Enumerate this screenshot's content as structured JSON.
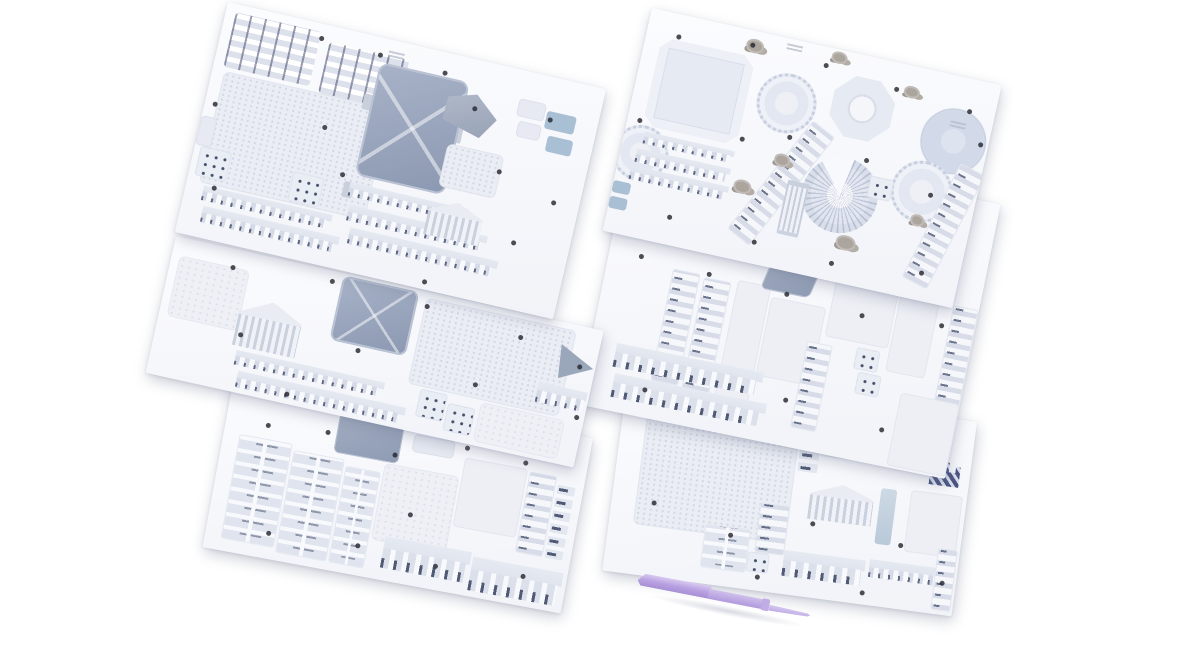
{
  "page": {
    "title": "3D puzzle model kit — die-cut sheets product photo",
    "background_color": "#ffffff"
  },
  "scene": {
    "description": "Six white die-cut model sheets with pale blue-grey architectural puzzle pieces arranged in two overlapping fanned stacks on a white background, with a lavender plastic assembly stylus lying below the right stack",
    "sheets": [
      {
        "label": "top-left sheet",
        "pieces": "stair strips, brick-textured wall panels, large slate roof panel, gable piece, window blocks, colonnade comb strips, temple pediment, punch holes"
      },
      {
        "label": "middle-left sheet",
        "pieces": "slate roof square, temple pediment, colonnade comb strips, window blocks, textured panels, triangular piece"
      },
      {
        "label": "bottom-left sheet",
        "pieces": "stacked slat strips, slate roof section, textured panel, plain panels, ladder strip, window-mark strip, wide-tooth combs"
      },
      {
        "label": "top-right sheet",
        "pieces": "chamfered base plate, scalloped dome rings, octagonal ring, large disc, curved stair fan, fluted column, diagonal ladder strips, comb strips, tan detail clusters"
      },
      {
        "label": "middle-right sheet",
        "pieces": "ladder strips, plain panels, slate piece, window blocks, wide-tooth combs"
      },
      {
        "label": "bottom-right sheet",
        "pieces": "large textured base panel, plain panels, navy hatched piece, temple pediment, pale blue bar, comb strips"
      }
    ],
    "tool": {
      "label": "assembly stylus",
      "color": "#bda7e2"
    },
    "palette": {
      "background": "#ffffff",
      "sheet_surface": "#f8f9fc",
      "piece_light": "#e6eaf2",
      "piece_texture": "#e9edf4",
      "roof_slate": "#93a0b8",
      "dark_mark": "#3f4a68",
      "navy_hatched": "#46527c",
      "blue_tab": "#a9bfd4",
      "tan_cluster": "#a8a29b",
      "tool_lavender": "#bda7e2",
      "punch_dot": "#26262e"
    },
    "counts": {
      "sheets": 6,
      "tools": 1
    }
  }
}
